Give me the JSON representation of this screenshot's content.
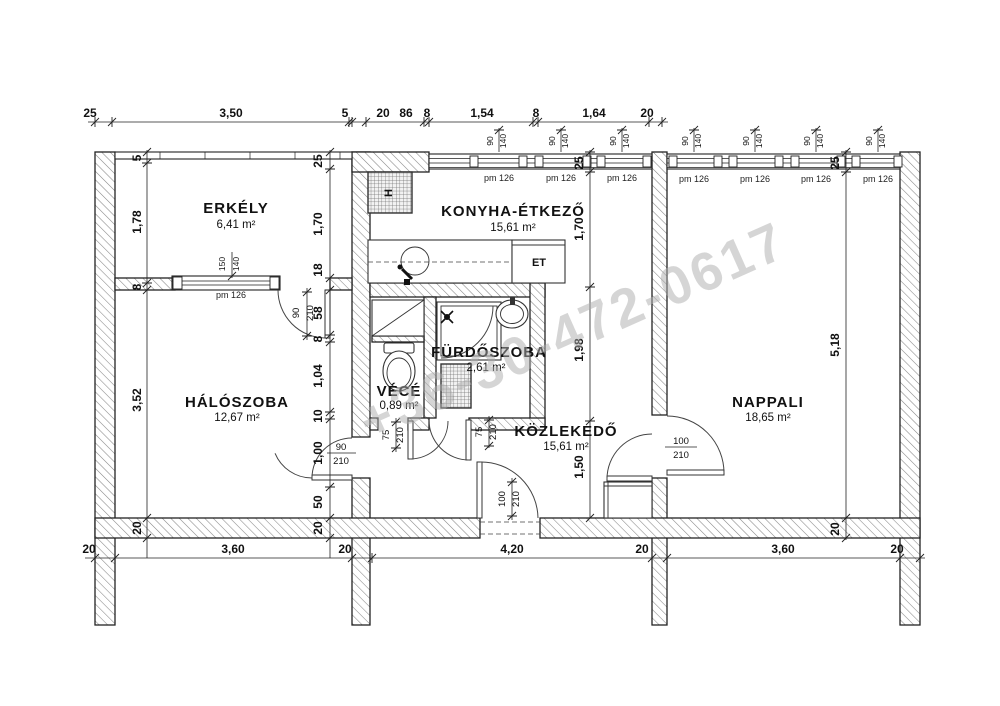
{
  "watermark": "+36-30-472-0617",
  "rooms": {
    "erkely": {
      "name": "ERKÉLY",
      "area": "6,41 m²"
    },
    "konyha": {
      "name": "KONYHA-ÉTKEZŐ",
      "area": "15,61 m²"
    },
    "haloszoba": {
      "name": "HÁLÓSZOBA",
      "area": "12,67 m²"
    },
    "furdoszoba": {
      "name": "FÜRDŐSZOBA",
      "area": "2,61 m²"
    },
    "vece": {
      "name": "VÉCÉ",
      "area": "0,89 m²"
    },
    "kozlekedo": {
      "name": "KÖZLEKEDŐ",
      "area": "15,61 m²"
    },
    "nappali": {
      "name": "NAPPALI",
      "area": "18,65 m²"
    }
  },
  "fixtures": {
    "dining_table": "ET",
    "kitchen_unit": "H"
  },
  "windows": {
    "label": "pm 126",
    "width": "90",
    "height": "140",
    "bedroom_width": "150",
    "bedroom_height": "140"
  },
  "doors": {
    "balcony": {
      "w": "90",
      "h": "210"
    },
    "bedroom": {
      "w": "90",
      "h": "210"
    },
    "wc": {
      "w": "75",
      "h": "210"
    },
    "bath": {
      "w": "75",
      "h": "210"
    },
    "entry": {
      "w": "100",
      "h": "210"
    },
    "living": {
      "w": "100",
      "h": "210"
    }
  },
  "dims": {
    "top": [
      "25",
      "3,50",
      "5",
      "20",
      "86",
      "8",
      "1,54",
      "8",
      "1,64",
      "20"
    ],
    "bottom": [
      "20",
      "3,60",
      "20",
      "4,20",
      "20",
      "3,60",
      "20"
    ],
    "left": [
      "5",
      "1,78",
      "8",
      "3,52",
      "20"
    ],
    "balcony_right": [
      "25",
      "1,70",
      "18"
    ],
    "bedroom_right": [
      "58",
      "8",
      "1,04",
      "10",
      "1,00",
      "50",
      "20"
    ],
    "kitchen": [
      "25",
      "1,70",
      "1,98",
      "1,50"
    ],
    "living": [
      "25",
      "5,18",
      "20"
    ]
  }
}
